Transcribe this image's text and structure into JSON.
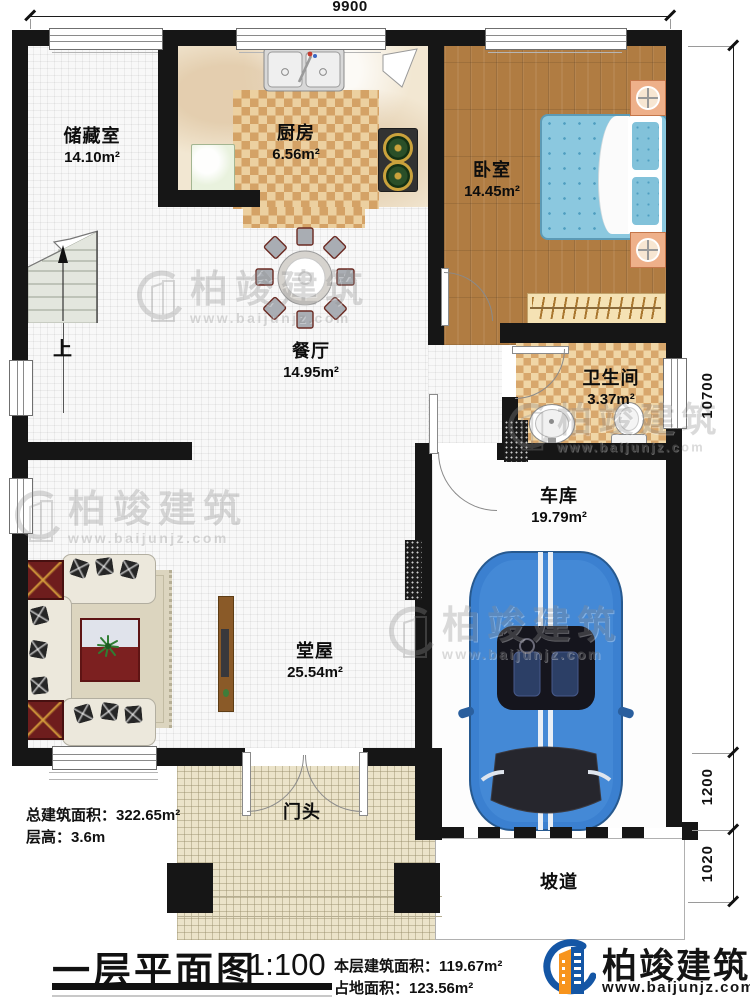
{
  "dimensions": {
    "width_top": "9900",
    "height_main": "10700",
    "height_garage_door": "1200",
    "height_ramp": "1020"
  },
  "rooms": {
    "storage": {
      "name": "储藏室",
      "area": "14.10m²"
    },
    "kitchen": {
      "name": "厨房",
      "area": "6.56m²"
    },
    "bedroom": {
      "name": "卧室",
      "area": "14.45m²"
    },
    "dining": {
      "name": "餐厅",
      "area": "14.95m²"
    },
    "bathroom": {
      "name": "卫生间",
      "area": "3.37m²"
    },
    "hall": {
      "name": "堂屋",
      "area": "25.54m²"
    },
    "garage": {
      "name": "车库",
      "area": "19.79m²"
    },
    "porch": {
      "name": "门头"
    },
    "ramp": {
      "name": "坡道"
    }
  },
  "stairs": {
    "up_label": "上"
  },
  "notes": {
    "total_area": "总建筑面积：322.65m²",
    "floor_height": "层高：3.6m"
  },
  "title_block": {
    "title": "一层平面图",
    "scale": "1:100",
    "floor_area": "本层建筑面积：119.67m²",
    "footprint_area": "占地面积：123.56m²"
  },
  "brand": {
    "name": "柏竣建筑",
    "site": "www.baijunjz.com"
  },
  "watermark": {
    "name": "柏竣建筑",
    "site": "www.baijunjz.com"
  },
  "colors": {
    "wall": "#161616",
    "wood_floor": "#b07c42",
    "bed_blue": "#8bc8df",
    "checker_dark": "#d4a266",
    "checker_light": "#ecd0a0",
    "car_blue": "#3b80d0",
    "brand_blue": "#1456a5",
    "brand_orange": "#f7941d"
  }
}
